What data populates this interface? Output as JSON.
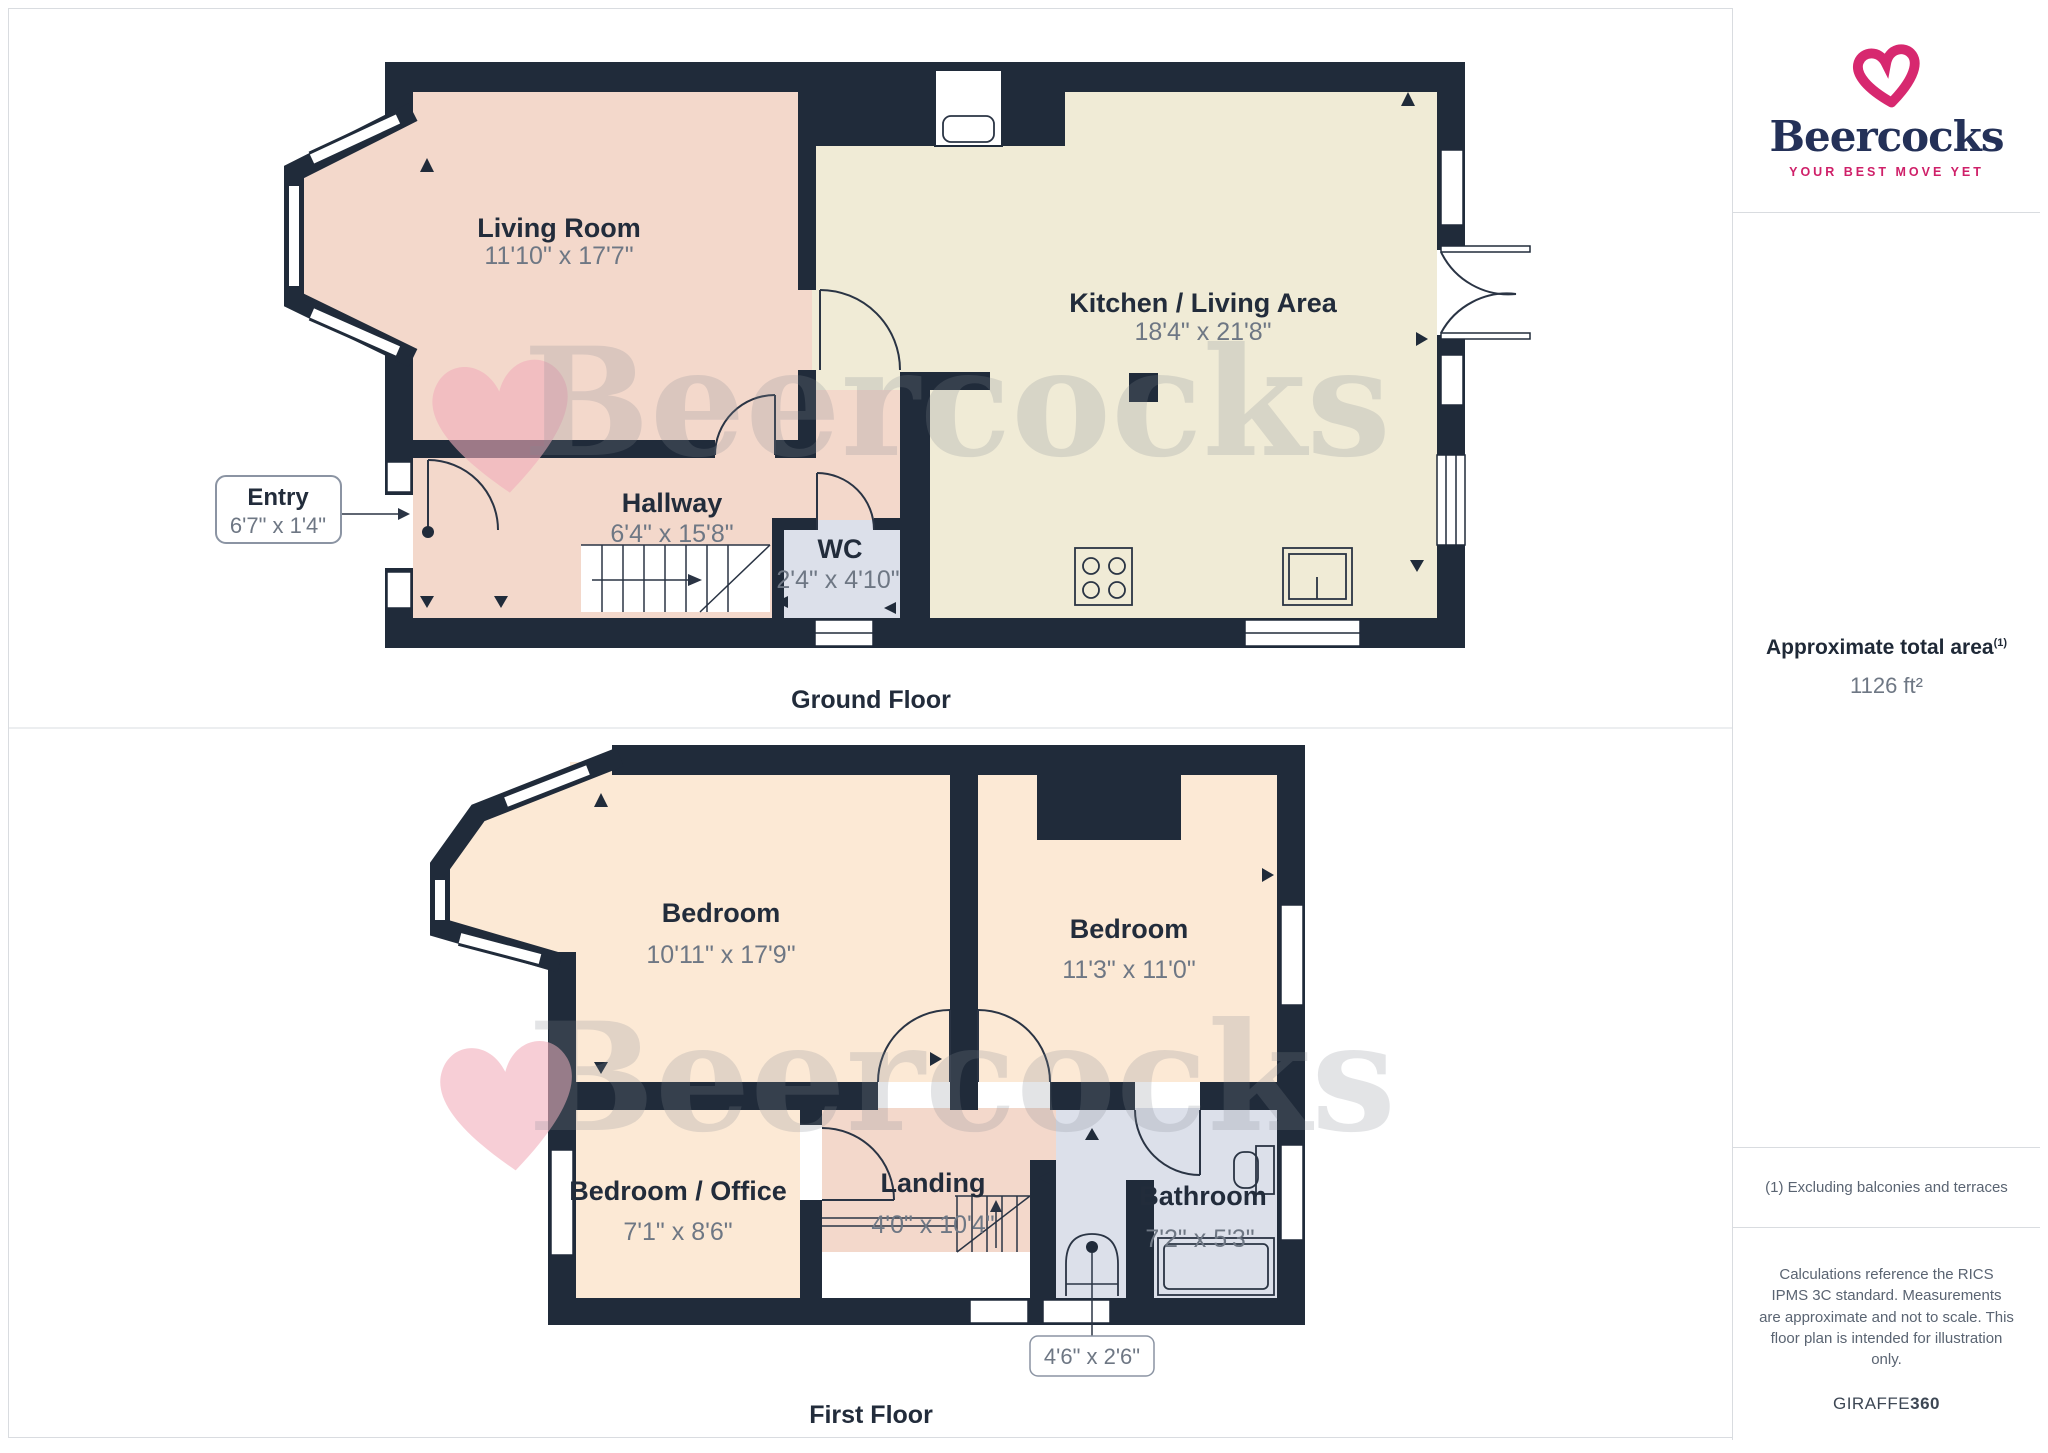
{
  "brand": {
    "name": "Beercocks",
    "tagline": "YOUR BEST MOVE YET"
  },
  "ground_floor": {
    "caption": "Ground Floor",
    "living_room": {
      "name": "Living Room",
      "dims": "11'10\" x 17'7\""
    },
    "kitchen": {
      "name": "Kitchen / Living Area",
      "dims": "18'4\" x 21'8\""
    },
    "hallway": {
      "name": "Hallway",
      "dims": "6'4\" x 15'8\""
    },
    "wc": {
      "name": "WC",
      "dims": "2'4\" x 4'10\""
    },
    "entry": {
      "name": "Entry",
      "dims": "6'7\" x 1'4\""
    }
  },
  "first_floor": {
    "caption": "First Floor",
    "bedroom1": {
      "name": "Bedroom",
      "dims": "10'11\" x 17'9\""
    },
    "bedroom2": {
      "name": "Bedroom",
      "dims": "11'3\" x 11'0\""
    },
    "bedroom_office": {
      "name": "Bedroom / Office",
      "dims": "7'1\" x 8'6\""
    },
    "landing": {
      "name": "Landing",
      "dims": "4'0\" x 10'4\""
    },
    "bathroom": {
      "name": "Bathroom",
      "dims": "7'2\" x 5'3\""
    },
    "cupboard": {
      "dims": "4'6\" x 2'6\""
    }
  },
  "sidebar": {
    "area_title": "Approximate total area",
    "area_footnote_ref": "(1)",
    "area_value": "1126 ft²",
    "footnote": "(1) Excluding balconies and terraces",
    "disclaimer": "Calculations reference the RICS IPMS 3C standard. Measurements are approximate and not to scale. This floor plan is intended for illustration only.",
    "credit_regular": "GIRAFFE",
    "credit_bold": "360"
  },
  "watermark": {
    "text": "Beercocks"
  },
  "colors": {
    "wall": "#202b3a",
    "room_pink": "#f3d8cb",
    "room_cream": "#f0ebd6",
    "room_peach": "#fce9d5",
    "room_blue": "#dce0ea",
    "brand_pink": "#d7286f",
    "brand_navy": "#243158",
    "label_text": "#222c3b",
    "dims_text": "#6e7784",
    "border": "#d9dce0"
  }
}
